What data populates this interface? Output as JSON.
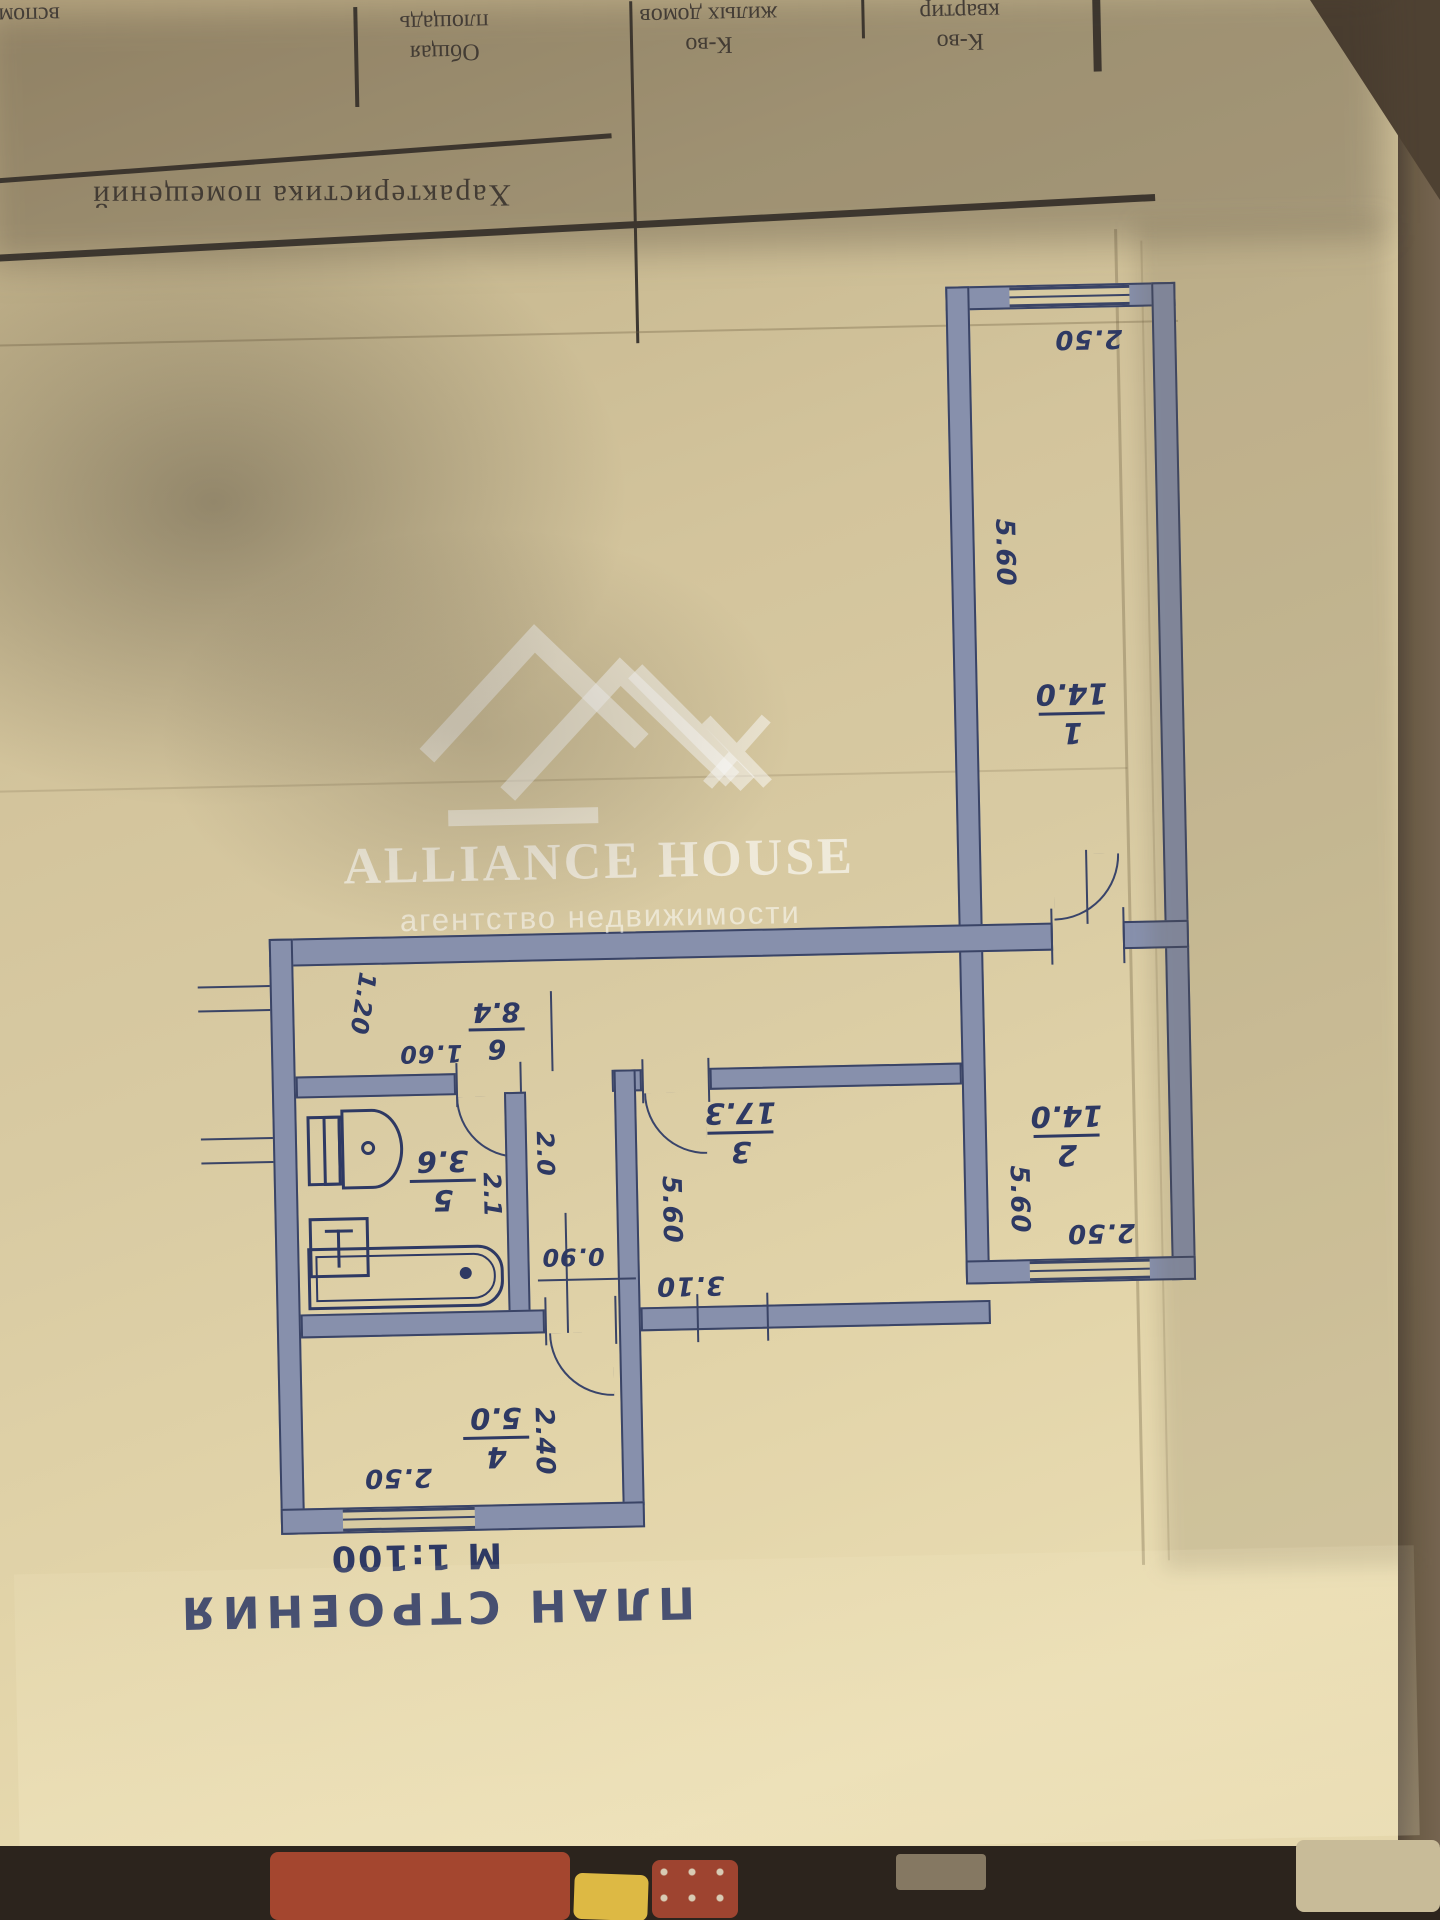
{
  "table": {
    "col_aux": "вспомог.",
    "col_area_line1": "Общая",
    "col_area_line2": "площадь",
    "col_homes_line1": "К-во",
    "col_homes_line2": "жилых домов",
    "col_flats_line1": "К-во",
    "col_flats_line2": "квартир",
    "section_title": "Характеристика помещений"
  },
  "plan": {
    "title": "ПЛАН СТРОЕНИЯ",
    "scale": "М 1:100",
    "rooms": [
      {
        "num": "1",
        "area": "14.0"
      },
      {
        "num": "2",
        "area": "14.0"
      },
      {
        "num": "3",
        "area": "17.3"
      },
      {
        "num": "4",
        "area": "5.0"
      },
      {
        "num": "5",
        "area": "3.6"
      },
      {
        "num": "6",
        "area": "8.4"
      }
    ],
    "dims": {
      "room1_width": "2.50",
      "room1_depth": "5.60",
      "room2_width": "2.50",
      "room2_depth": "5.60",
      "room3_width": "3.10",
      "room3_depth": "5.60",
      "room4_width": "2.50",
      "room4_depth": "2.40",
      "bath_width": "2.1",
      "bath_wall": "2.0",
      "hall_seg": "1.60",
      "hall_depth": "1.20",
      "door": "0.90"
    }
  },
  "watermark": {
    "brand": "ALLIANCE HOUSE",
    "tagline": "агентство недвижимости"
  }
}
